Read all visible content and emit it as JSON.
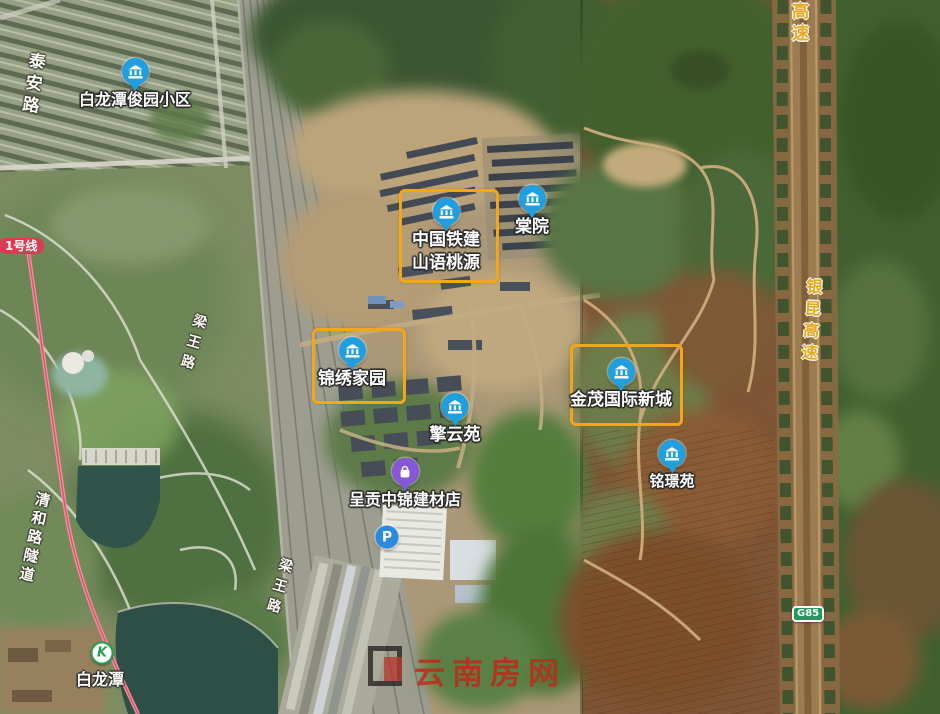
{
  "map": {
    "description": "satellite map screenshot with highlighted residential projects",
    "highlight_color": "#f2a71b",
    "pois": [
      {
        "id": "bailongtan-junyuan-xiaoqu",
        "label_lines": [
          "白龙潭俊园小区"
        ],
        "icon": "building",
        "x": 135,
        "y": 72,
        "font_size": 16,
        "boxed": false
      },
      {
        "id": "zhongguotiejian-shanyutaoyuan",
        "label_lines": [
          "中国铁建",
          "山语桃源"
        ],
        "icon": "building",
        "x": 446,
        "y": 212,
        "font_size": 17,
        "boxed": true,
        "box": {
          "x": 399,
          "y": 189,
          "w": 94,
          "h": 88
        }
      },
      {
        "id": "tangyuan",
        "label_lines": [
          "棠院"
        ],
        "icon": "building",
        "x": 532,
        "y": 199,
        "font_size": 17,
        "boxed": false
      },
      {
        "id": "jinxiu-jiayuan",
        "label_lines": [
          "锦绣家园"
        ],
        "icon": "building",
        "x": 352,
        "y": 351,
        "font_size": 17,
        "boxed": true,
        "box": {
          "x": 312,
          "y": 328,
          "w": 88,
          "h": 70
        }
      },
      {
        "id": "qingyunyuan",
        "label_lines": [
          "擎云苑"
        ],
        "icon": "building",
        "x": 455,
        "y": 407,
        "font_size": 17,
        "boxed": false
      },
      {
        "id": "jinmao-guoji-xincheng",
        "label_lines": [
          "金茂国际新城"
        ],
        "icon": "building",
        "x": 621,
        "y": 372,
        "font_size": 17,
        "boxed": true,
        "box": {
          "x": 570,
          "y": 344,
          "w": 107,
          "h": 76
        }
      },
      {
        "id": "mingjingyuan",
        "label_lines": [
          "铭璟苑"
        ],
        "icon": "building",
        "x": 672,
        "y": 454,
        "font_size": 15,
        "boxed": false
      },
      {
        "id": "chenggong-zhongjin-jiancaidian",
        "label_lines": [
          "呈贡中锦建材店"
        ],
        "icon": "shop",
        "x": 405,
        "y": 472,
        "font_size": 16,
        "boxed": false
      }
    ],
    "road_labels": [
      {
        "id": "taian-road",
        "text": "泰安路",
        "style": "white",
        "x": 24,
        "y": 52,
        "font_size": 17,
        "letter_spacing": 5,
        "rotate": 8
      },
      {
        "id": "liangwang-road-north",
        "text": "梁王路",
        "style": "white",
        "x": 191,
        "y": 314,
        "font_size": 14,
        "letter_spacing": 7,
        "rotate": 16
      },
      {
        "id": "liangwang-road-south",
        "text": "梁王路",
        "style": "white",
        "x": 277,
        "y": 558,
        "font_size": 14,
        "letter_spacing": 7,
        "rotate": 16
      },
      {
        "id": "qinghe-road-tunnel",
        "text": "清和路隧道",
        "style": "white",
        "x": 34,
        "y": 492,
        "font_size": 15,
        "letter_spacing": 4,
        "rotate": 12
      },
      {
        "id": "yinkun-expressway-north",
        "text": "银昆高速",
        "style": "yellow",
        "x": 786,
        "y": -42,
        "font_size": 17,
        "letter_spacing": 5,
        "rotate": 0
      },
      {
        "id": "yinkun-expressway-mid",
        "text": "银昆高速",
        "style": "yellow",
        "x": 801,
        "y": 278,
        "font_size": 16,
        "letter_spacing": 6,
        "rotate": 4
      }
    ],
    "badges": [
      {
        "id": "metro-line-1",
        "text": "1号线",
        "type": "metro",
        "x": -2,
        "y": 238,
        "color": "#dc3a50"
      },
      {
        "id": "g85",
        "text": "G85",
        "type": "highway",
        "x": 792,
        "y": 606,
        "color": "#1f9b5e"
      }
    ],
    "metro_station": {
      "id": "bailongtan-station",
      "name": "白龙潭",
      "glyph": "K",
      "x": 102,
      "y": 653,
      "label_y": 666,
      "font_size": 16
    },
    "parking": {
      "letter": "P",
      "x": 387,
      "y": 537
    },
    "watermark": {
      "text": "云南房网",
      "color": "#c1281a"
    }
  }
}
